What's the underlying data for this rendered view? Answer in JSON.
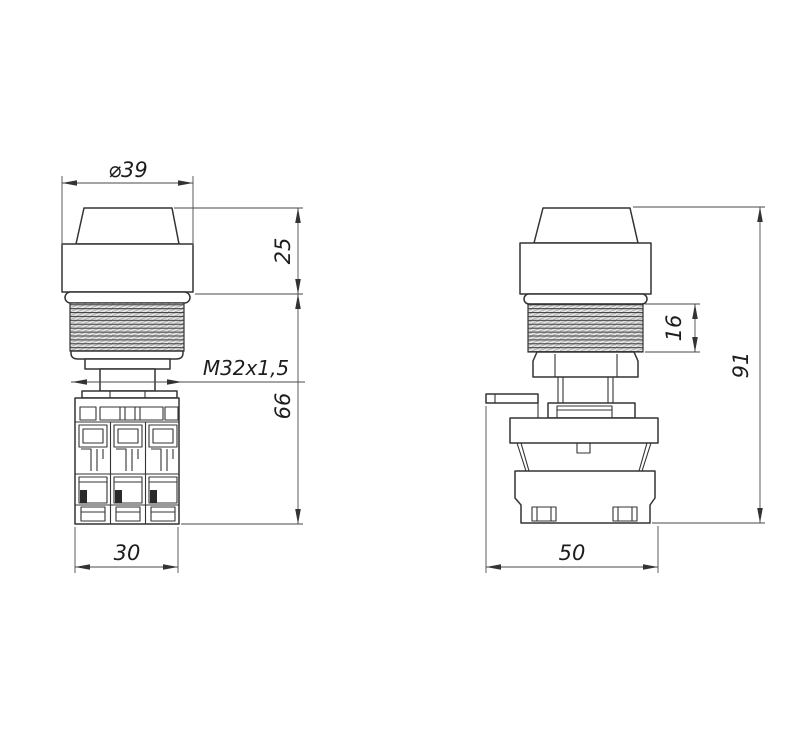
{
  "page": {
    "background": "#ffffff",
    "description": "Two-view technical drawing of a push button with contact block"
  },
  "drawing": {
    "line_color": "#333333",
    "dim_color": "#4a4a4a",
    "views": {
      "front": {
        "label": "front-view"
      },
      "side": {
        "label": "side-view"
      }
    },
    "dimensions": {
      "front": {
        "diameter": "⌀39",
        "head_height": "25",
        "thread": "M32x1,5",
        "body_height": "66",
        "block_width": "30"
      },
      "side": {
        "thread_length": "16",
        "total_height": "91",
        "housing_width": "50"
      }
    }
  }
}
